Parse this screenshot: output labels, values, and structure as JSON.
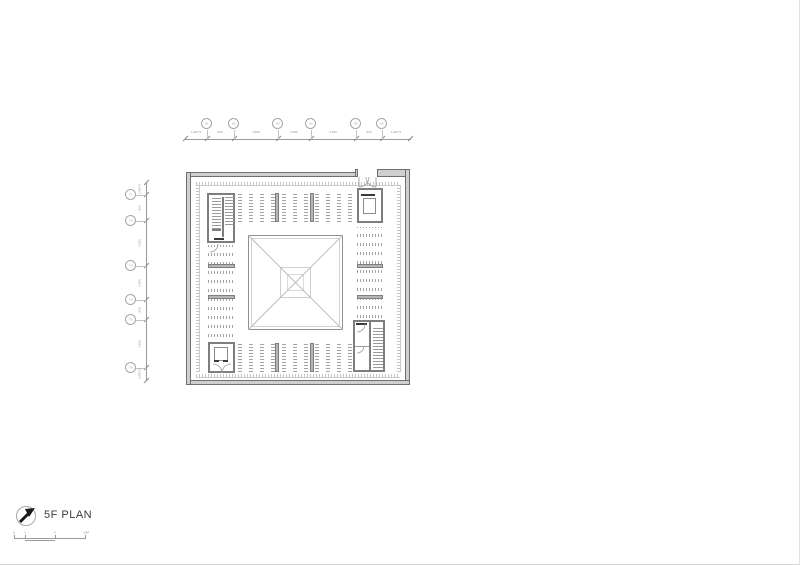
{
  "sheet": {
    "type": "architectural-floor-plan",
    "background": "#ffffff"
  },
  "title_block": {
    "title": "5F PLAN",
    "north_icon": "north-arrow-icon"
  },
  "scale_bar": {
    "labels": [
      "0",
      "1",
      "5",
      "10M"
    ]
  },
  "grid": {
    "top": {
      "labels": [
        "X1",
        "X2",
        "X3",
        "X4",
        "X5",
        "X6"
      ],
      "dims": [
        "1,087.5",
        "920",
        "4,520",
        "3,400",
        "4,520",
        "920",
        "1,087.5"
      ]
    },
    "left": {
      "labels": [
        "Y1",
        "Y2",
        "Y3",
        "Y4",
        "Y5",
        "Y6"
      ],
      "dims": [
        "1,087.5",
        "920",
        "4,520",
        "3,400",
        "920",
        "4,520",
        "1,087.5"
      ]
    }
  },
  "colors": {
    "wall_fill": "#cfcfcf",
    "wall_edge": "#6f6f6f",
    "core_wall": "#7e7e7e",
    "stack_line": "#a3a3a3",
    "dim_line": "#9b9b9b",
    "text": "#3c3c3c"
  }
}
